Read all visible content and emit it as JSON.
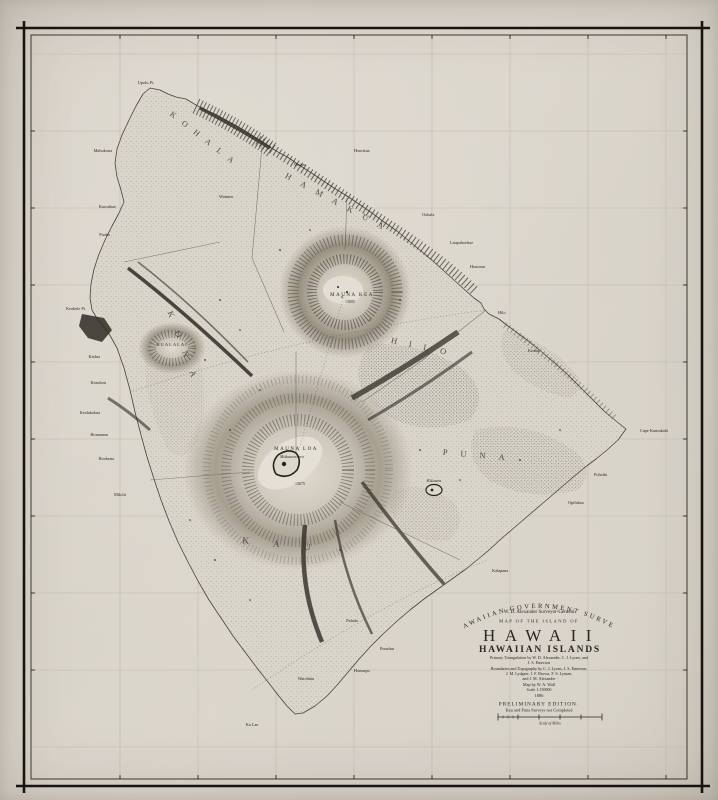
{
  "title_block": {
    "survey_arc": "HAWAIIAN  GOVERNMENT  SURVEY",
    "surveyor_line": "W. D. Alexander   Surveyor-General",
    "map_of": "MAP OF THE ISLAND OF",
    "island_name": "HAWAII",
    "group_name": "HAWAIIAN ISLANDS",
    "credit1": "Primary Triangulation by W. D. Alexander, C. J. Lyons, and",
    "credit2": "J. S. Emerson",
    "credit3": "Boundaries and Topography by C. J. Lyons, J. S. Emerson,",
    "credit4": "J. M. Lydgate,  J. F. Brown,  F. S. Lyman,",
    "credit5": "and J. M. Alexander",
    "map_by": "Map by W. A. Wall",
    "scale_text": "Scale 1:150000",
    "year": "1886",
    "edition": "PRELIMINARY EDITION.",
    "edition_note": "Kau and Puna Surveys not Completed",
    "scale_bar_label": "Scale of Miles"
  },
  "districts": [
    {
      "label": "KOHALA"
    },
    {
      "label": "HAMAKUA"
    },
    {
      "label": "HILO"
    },
    {
      "label": "PUNA"
    },
    {
      "label": "KAU"
    },
    {
      "label": "KONA"
    }
  ],
  "peaks": {
    "mauna_kea": "MAUNA KEA",
    "mauna_kea_elev": "13805",
    "mauna_loa": "MAUNA LOA",
    "mokuaweoweo": "Mokuaweoweo",
    "mauna_loa_elev": "13675",
    "hualalai": "HUALALAI",
    "kilauea": "Kilauea"
  },
  "places": [
    {
      "label": "Upolu Pt."
    },
    {
      "label": "Mahukona"
    },
    {
      "label": "Kawaihae"
    },
    {
      "label": "Puako"
    },
    {
      "label": "Keahole Pt."
    },
    {
      "label": "Kailua"
    },
    {
      "label": "Keauhou"
    },
    {
      "label": "Kealakekua"
    },
    {
      "label": "Honaunau"
    },
    {
      "label": "Hookena"
    },
    {
      "label": "Milolii"
    },
    {
      "label": "Ka Lae"
    },
    {
      "label": "Waiohinu"
    },
    {
      "label": "Honuapo"
    },
    {
      "label": "Punaluu"
    },
    {
      "label": "Pahala"
    },
    {
      "label": "Kalapana"
    },
    {
      "label": "Opihikao"
    },
    {
      "label": "Pohoiki"
    },
    {
      "label": "Cape Kumukahi"
    },
    {
      "label": "Keaau"
    },
    {
      "label": "Hilo"
    },
    {
      "label": "Honomu"
    },
    {
      "label": "Laupahoehoe"
    },
    {
      "label": "Ookala"
    },
    {
      "label": "Honokaa"
    },
    {
      "label": "Waipio"
    },
    {
      "label": "Waimea"
    }
  ]
}
